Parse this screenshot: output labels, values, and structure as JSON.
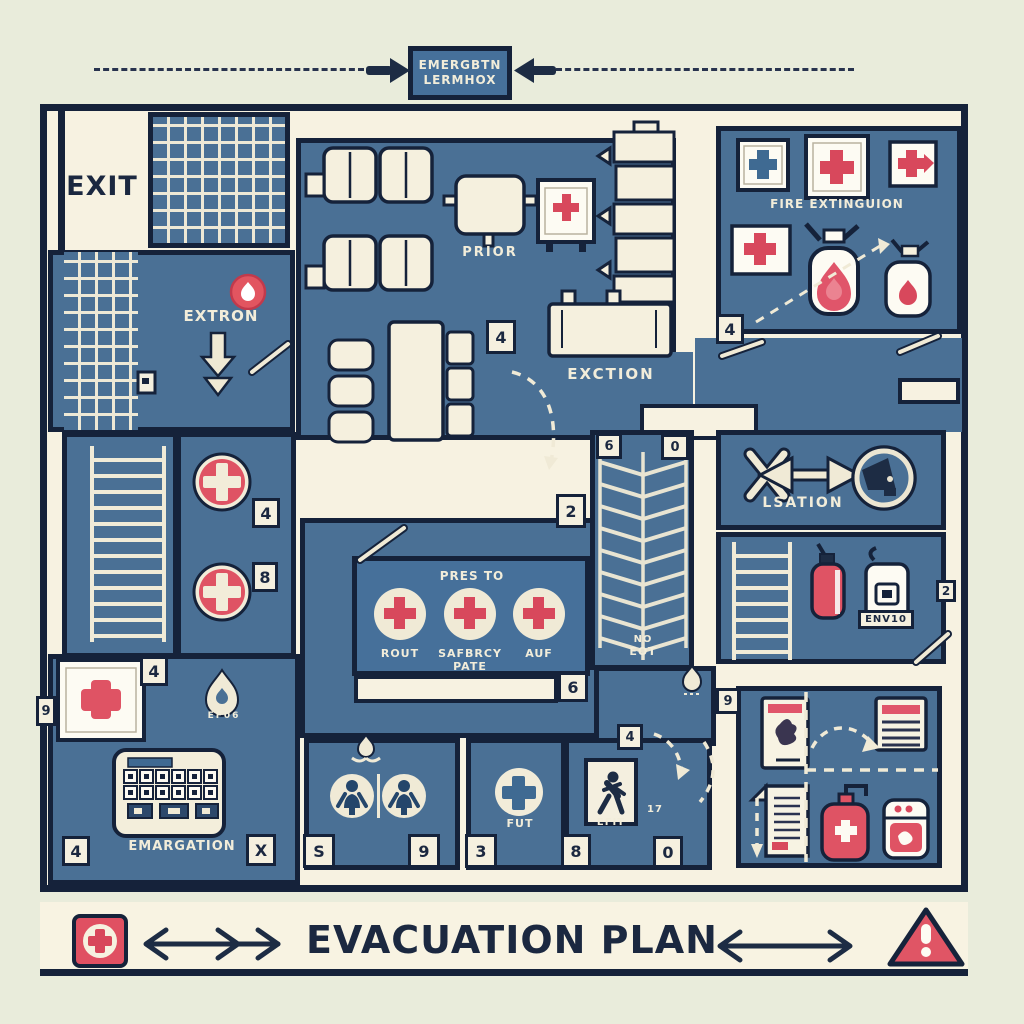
{
  "header": {
    "sign_line1": "EMERGBTN",
    "sign_line2": "LERMHOX"
  },
  "banner": {
    "title": "EVACUATION PLAN"
  },
  "labels": {
    "exit": "EXIT",
    "extron": "EXTRON",
    "prior": "PRIOR",
    "exction": "EXCTION",
    "fire_room": "FIRE EXTINGUION",
    "lsation": "LSATION",
    "device": "ENV10",
    "no_exit_1": "NO",
    "no_exit_2": "EOT",
    "panel_title": "PRES TO",
    "panel_item1": "ROUT",
    "panel_item2a": "SAFBRCY",
    "panel_item2b": "PATE",
    "panel_item3": "AUF",
    "flame_store": "EF06",
    "emargation": "EMARGATION",
    "fut": "FUT",
    "exit_sign": "EFIT",
    "room_number": "17"
  },
  "markers": {
    "mid_room": "4",
    "fire_room": "4",
    "stair_top_left": "6",
    "stair_top_right": "0",
    "stair_side": "2",
    "medical_a": "4",
    "medical_b": "8",
    "right_edge": "2",
    "corridor": "6",
    "storage_top": "9",
    "far_left": "9",
    "supply_top": "4",
    "bottom_left": "4",
    "bottom_x": "X",
    "restroom_a": "S",
    "restroom_b": "9",
    "firstaid_room": "3",
    "exit_room_a": "8",
    "exit_room_b": "0",
    "exit_room_top": "4"
  },
  "colors": {
    "background": "#e9ecdb",
    "floor": "#f7f2e1",
    "room_blue": "#4a7095",
    "wall": "#15223a",
    "accent_red": "#dd5464",
    "text_light": "#f2edda",
    "text_dark": "#1b2840"
  },
  "icons": {
    "first_aid": "red-cross-circle",
    "first_aid_box": "wall-cross-sign",
    "fire_extinguisher": "extinguisher-with-flame",
    "flame": "flame",
    "exit_down_arrow": "block-arrow-down",
    "assembly_point": "megaphone-circle",
    "direction_arrows": "double-headed-arrow",
    "warning": "exclamation-triangle",
    "running_man": "exit-runner",
    "restroom_person": "person-circle",
    "keypad": "control-panel",
    "stairs": "grid-hatch",
    "ladder": "rung-hatch",
    "stairwell": "chevron-stairs"
  }
}
